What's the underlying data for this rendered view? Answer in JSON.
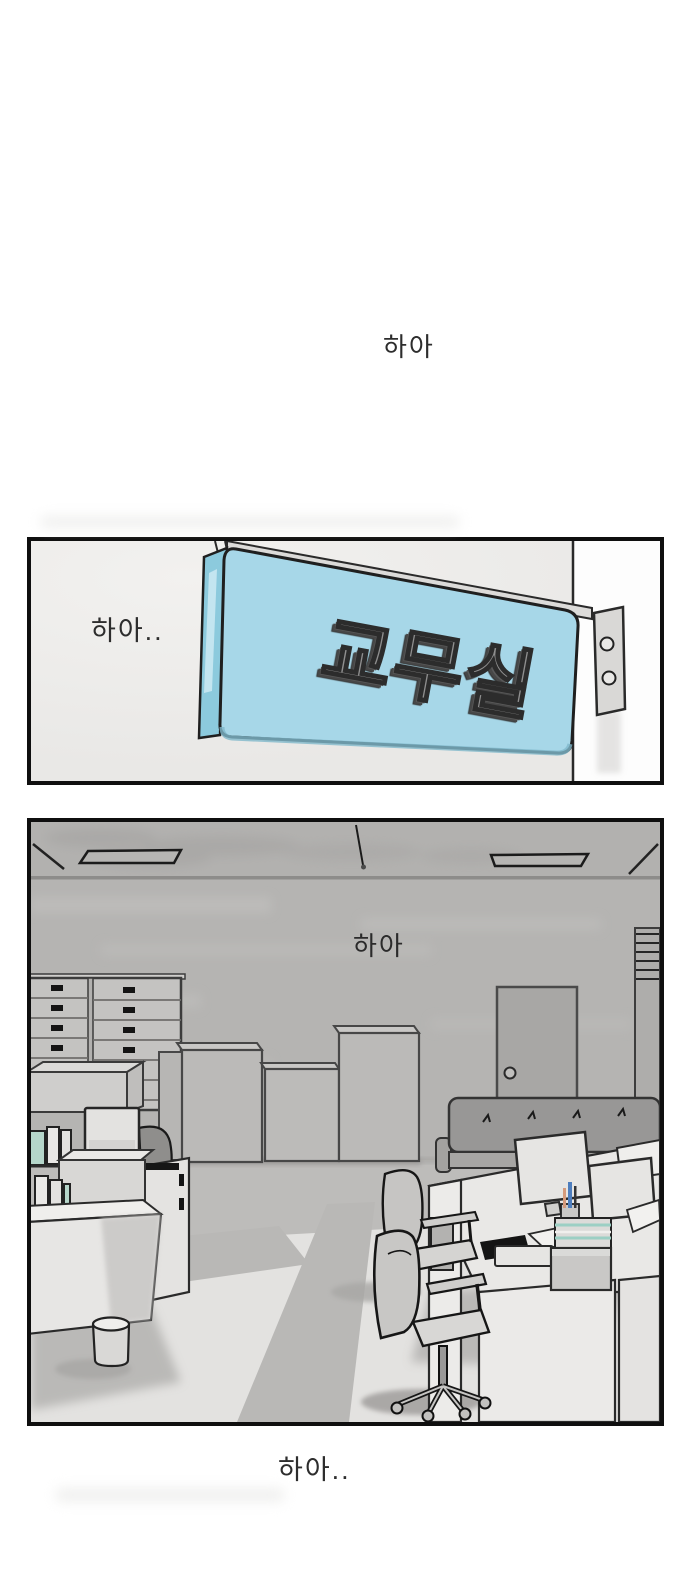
{
  "comic": {
    "background_color": "#ffffff",
    "sfx": {
      "top": "하아",
      "panel1": "하아..",
      "panel2": "하아",
      "bottom": "하아.."
    },
    "panel1": {
      "sign_text": "교무실",
      "colors": {
        "sign_face": "#a7d7e8",
        "sign_side": "#8ccadd",
        "sign_side_highlight": "#cdeaf3",
        "sign_letters": "#8f8f8f",
        "wall": "#e9e8e6",
        "bracket": "#dcdbd9",
        "outline": "#1a1a1a"
      }
    },
    "panel2": {
      "colors": {
        "wall": "#b5b4b2",
        "ceiling": "#b2b1af",
        "floor_light": "#e3e2e0",
        "floor_dark": "#bdbcba",
        "sofa": "#989796",
        "door": "#a8a7a5",
        "paper_teal": "#9ccfc4",
        "book_teal": "#b5d6ca",
        "pen_blue": "#4d7dbd",
        "pen_orange": "#d59a7b",
        "outline": "#1a1a1a"
      }
    }
  }
}
